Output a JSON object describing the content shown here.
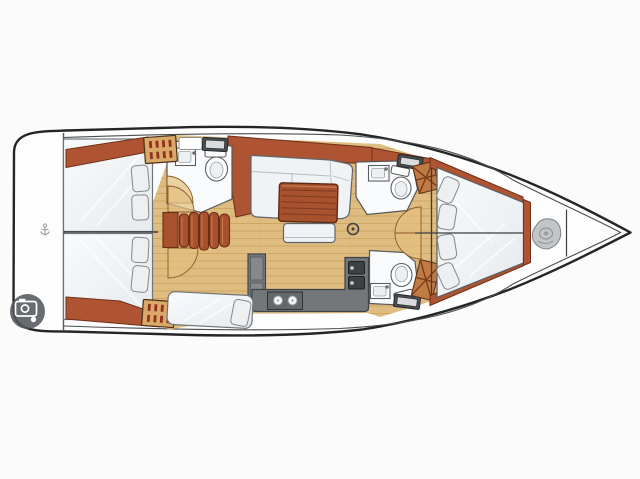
{
  "meta": {
    "type": "sailboat-interior-floor-plan",
    "view": "top-down",
    "bow_direction": "right"
  },
  "palette": {
    "bg": "#FBFBFB",
    "hull-line": "#232527",
    "wood": "#AE5433",
    "wood-dark": "#703018",
    "louver": "#D9A96A",
    "louver-slat": "#93301F",
    "floor": "#DFBC80",
    "plank": "#C9A360",
    "step": "#A8512F",
    "step-dark": "#6B2D15",
    "cushion": "#EFF3F6",
    "pillow": "#EDEFF1",
    "pillow-edge": "#83878B",
    "counter": "#73777A",
    "sink": "#3E4144",
    "hatch-dark": "#4C4F52",
    "hatch-light": "#D9DBDD",
    "door-fill": "#E3C17F",
    "door-edge": "#8A5A28",
    "badge": "#53575C",
    "coil": "#C3C6C8"
  },
  "legend": {
    "cabins": [
      "aft-cabin-upper",
      "aft-cabin-lower",
      "forward-v-berth-cabin"
    ],
    "heads": [
      "aft-head",
      "forward-head-upper",
      "forward-head-lower"
    ],
    "salon": [
      "l-shaped-settee",
      "dining-table",
      "bench-seat",
      "mast-post"
    ],
    "galley": [
      "refrigerator",
      "stove-two-burners",
      "double-sink",
      "counter"
    ],
    "other": [
      "companionway-steps",
      "swim-platform",
      "side-berth",
      "anchor-locker",
      "louvered-lockers"
    ]
  },
  "icons": [
    "camera-badge-icon",
    "anchor-icon",
    "rope-coil-icon"
  ],
  "counts": {
    "pillows_v_berth": 4,
    "pillows_aft_upper": 2,
    "pillows_aft_lower": 2,
    "stove_burners": 2,
    "sink_basins": 2,
    "deck_hatches": 3
  }
}
